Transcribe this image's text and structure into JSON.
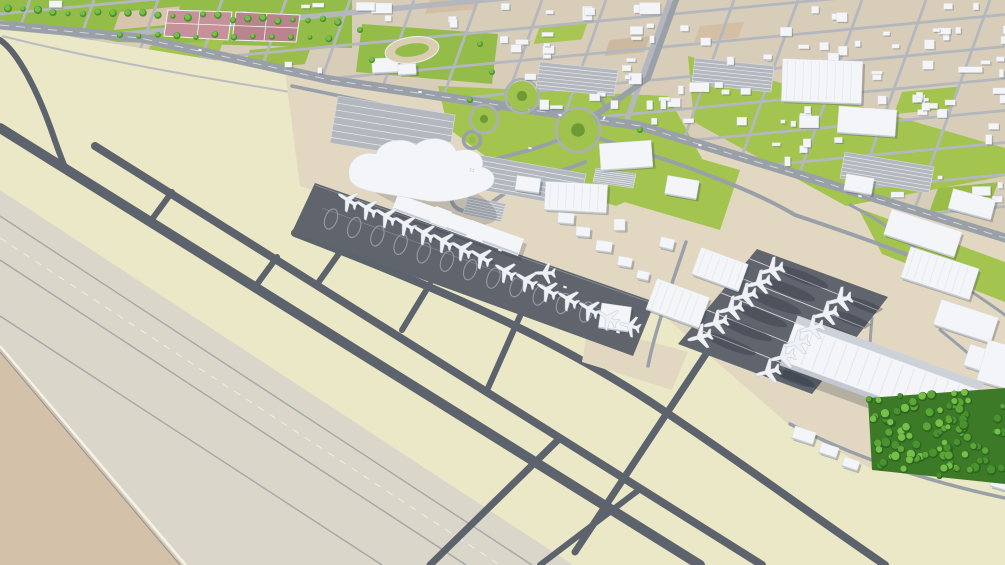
{
  "meta": {
    "title": "3D aerial map render of an airport district",
    "description": "Oblique low-poly 3D render: pale parallel runways lower-left with dark taxiways, a white terminal building with a row of parked airliners on a dark apron, a remote cargo apron with two facing rows of aircraft beside a long ribbed hangar, landside access roads with landscaped roundabouts, parking lots, a tennis-court park and running-track field upper-left, a dense tree grove lower-right, and a low-poly city grid of small white buildings across the top.",
    "render_style": "low-poly architectural 3D render",
    "visible_text": ""
  },
  "palette": {
    "infield": "#eae8c6",
    "runway": "#dad6c9",
    "dirt": "#d4c1aa",
    "taxiway": "#5d636c",
    "apron": "#5f646d",
    "city": "#d8cdb8",
    "sand": "#e2d8c2",
    "lawn": "#a3c44f",
    "lawn_dark": "#6e9a33",
    "park": "#94bc49",
    "road": "#9aa0a8",
    "street": "#b4b8be",
    "building": "#f3f5f8",
    "building_side": "#c3c8d0",
    "court": "#c6929a",
    "track": "#d9cdb2",
    "tree": "#5aa636",
    "tree_light": "#74c048",
    "forest_base": "#3c7a28",
    "plane": "#eef1f6",
    "marking": "#e6e9ee",
    "shadow": "rgba(45,52,65,0.30)"
  },
  "scene": {
    "counts": {
      "airliners": 28,
      "landscaped_roundabouts": 3,
      "runway_strips": 2,
      "tennis_courts": 4,
      "running_tracks": 1,
      "parking_lots": 7
    },
    "planes": {
      "heading_terminal": -58,
      "heading_remote": -104,
      "terminal_apron": [
        [
          348,
          200
        ],
        [
          367,
          208
        ],
        [
          386,
          216
        ],
        [
          405,
          224
        ],
        [
          424,
          233
        ],
        [
          443,
          241
        ],
        [
          462,
          249
        ],
        [
          481,
          257
        ],
        [
          505,
          271
        ],
        [
          526,
          280
        ],
        [
          547,
          290
        ],
        [
          568,
          299
        ],
        [
          589,
          309
        ],
        [
          608,
          318
        ]
      ],
      "remote_apron_left": [
        [
          700,
          337
        ],
        [
          716,
          323
        ],
        [
          731,
          309
        ],
        [
          745,
          296
        ],
        [
          759,
          283
        ],
        [
          772,
          270
        ]
      ],
      "remote_apron_right": [
        [
          768,
          372
        ],
        [
          783,
          357
        ],
        [
          797,
          343
        ],
        [
          812,
          328
        ],
        [
          826,
          314
        ],
        [
          840,
          300
        ]
      ],
      "other": [
        [
          630,
          326,
          -75
        ],
        [
          545,
          273,
          -90
        ]
      ]
    },
    "roundabouts": [
      {
        "x": 522,
        "y": 96,
        "r": 15
      },
      {
        "x": 578,
        "y": 130,
        "r": 20
      },
      {
        "x": 484,
        "y": 119,
        "r": 12
      }
    ],
    "forest": {
      "corners": [
        [
          868,
          398
        ],
        [
          1005,
          388
        ],
        [
          1005,
          484
        ],
        [
          872,
          470
        ]
      ],
      "tree_count": 95
    }
  }
}
